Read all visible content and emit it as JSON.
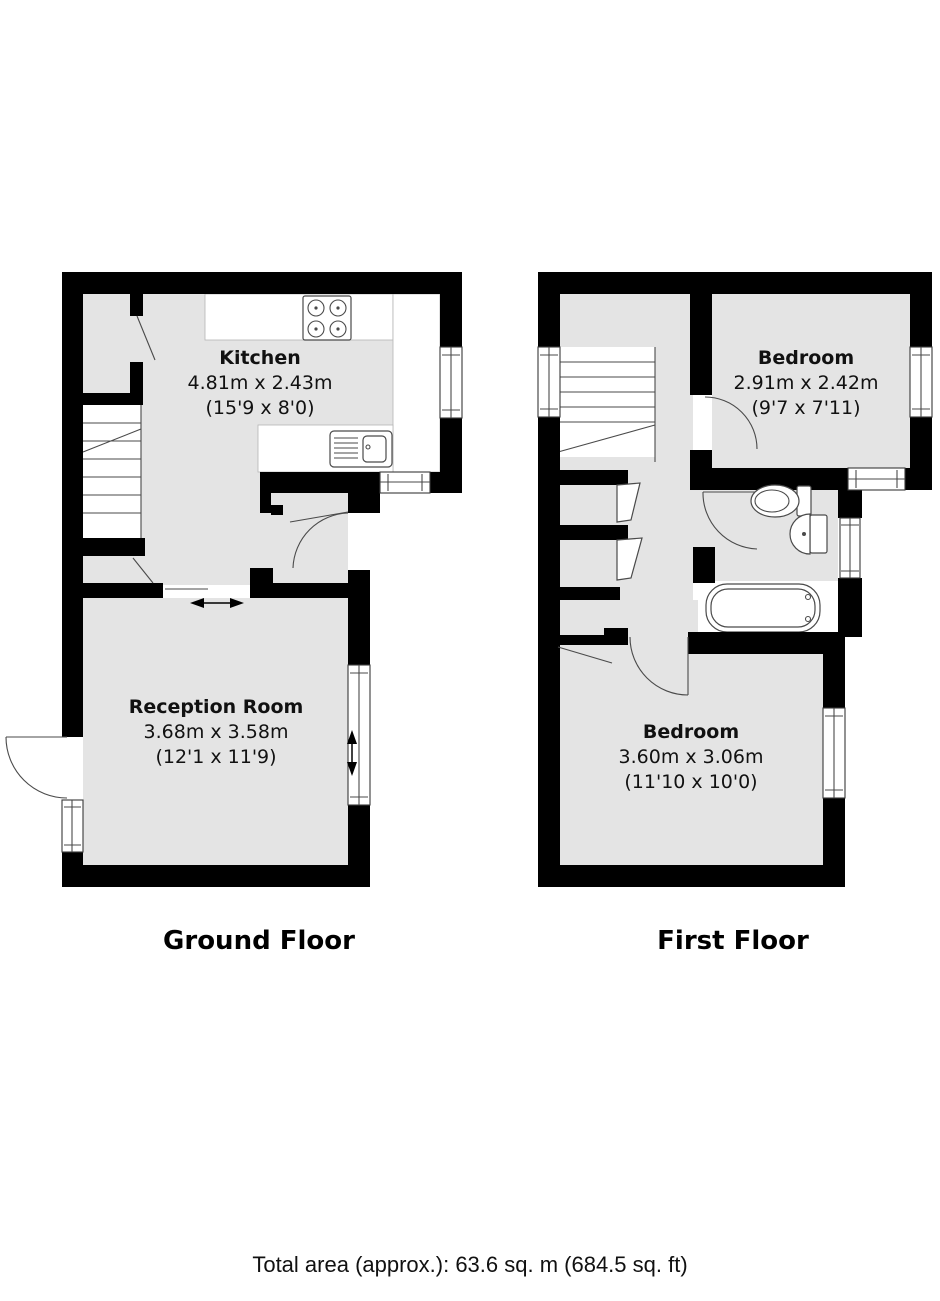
{
  "colors": {
    "wall": "#000000",
    "room_fill": "#e4e4e4",
    "line": "#4a4a4a",
    "background": "#ffffff",
    "text": "#111111"
  },
  "ground_floor": {
    "title": "Ground Floor",
    "kitchen": {
      "name": "Kitchen",
      "metric": "4.81m x 2.43m",
      "imperial": "(15'9 x 8'0)"
    },
    "reception": {
      "name": "Reception Room",
      "metric": "3.68m x 3.58m",
      "imperial": "(12'1 x 11'9)"
    }
  },
  "first_floor": {
    "title": "First Floor",
    "bedroom1": {
      "name": "Bedroom",
      "metric": "2.91m x 2.42m",
      "imperial": "(9'7 x 7'11)"
    },
    "bedroom2": {
      "name": "Bedroom",
      "metric": "3.60m x 3.06m",
      "imperial": "(11'10 x 10'0)"
    }
  },
  "footer": {
    "total_area": "Total area (approx.): 63.6 sq. m (684.5 sq. ft)"
  }
}
